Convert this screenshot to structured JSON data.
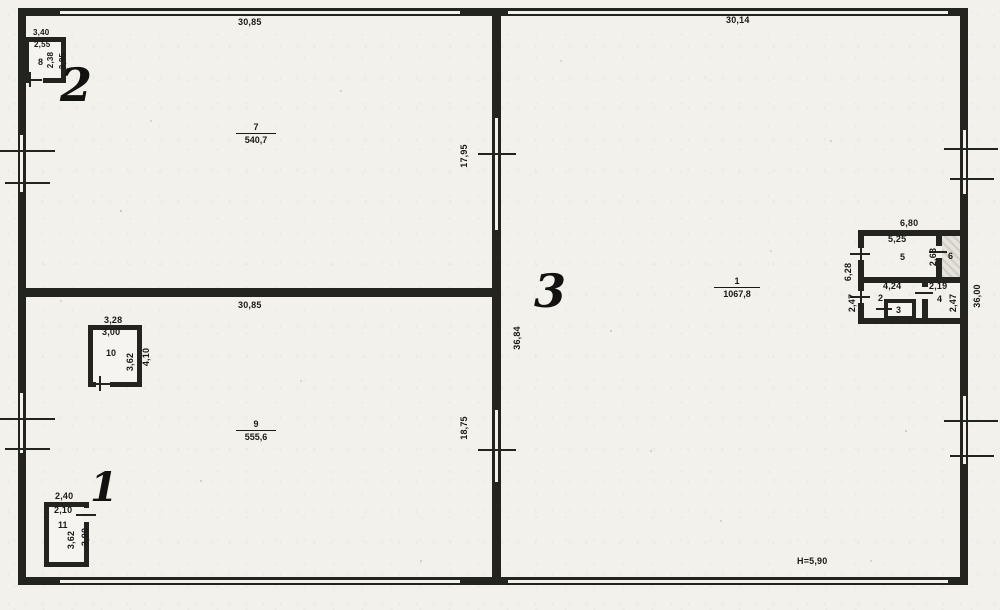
{
  "dims": {
    "top_left": "30,85",
    "top_right": "30,14",
    "mid_left": "30,85",
    "left_upper": "17,95",
    "left_lower": "18,75",
    "center": "36,84",
    "right": "36,00",
    "height_note": "H=5,90"
  },
  "areas": {
    "r7": {
      "num": "7",
      "val": "540,7"
    },
    "r9": {
      "num": "9",
      "val": "555,6"
    },
    "r1": {
      "num": "1",
      "val": "1067,8"
    }
  },
  "room8": {
    "num": "8",
    "width_outer": "3,40",
    "width_inner": "2,55",
    "height_inner": "2,38",
    "height_outer": "3,85"
  },
  "room10": {
    "num": "10",
    "width_outer": "3,28",
    "width_inner": "3,00",
    "height_inner": "3,62",
    "height_outer": "4,10"
  },
  "room11": {
    "num": "11",
    "width_outer": "2,40",
    "width_inner": "2,10",
    "height_inner": "3,62",
    "height_outer": "3,90"
  },
  "cluster": {
    "width_outer": "6,80",
    "height_total": "6,28",
    "r5": {
      "num": "5",
      "width_inner": "5,25",
      "height": "2,63"
    },
    "r6": {
      "num": "6"
    },
    "r2": {
      "num": "2",
      "width_inner": "4,24",
      "height": "2,47"
    },
    "r3": {
      "num": "3"
    },
    "r4": {
      "num": "4",
      "width_inner": "2,19",
      "height": "2,47"
    }
  },
  "marks": {
    "m1": "1",
    "m2": "2",
    "m3": "3"
  },
  "colors": {
    "paper": "#f3f1ec",
    "ink": "#23231f"
  }
}
